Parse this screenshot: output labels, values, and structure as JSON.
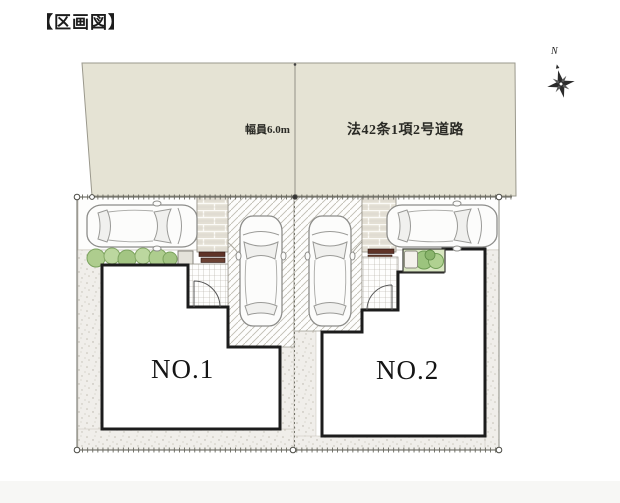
{
  "title": "【区画図】",
  "road": {
    "width_label": "幅員6.0m",
    "type_label": "法42条1項2号道路"
  },
  "compass": {
    "label": "N"
  },
  "lots": [
    {
      "label": "NO.1"
    },
    {
      "label": "NO.2"
    }
  ],
  "colors": {
    "road_fill": "#e5e3d4",
    "building_outline": "#1c1c1c",
    "building_fill": "#ffffff",
    "gravel_fill": "#f0eeea",
    "bush_green": "#aecd8e",
    "planting_bed_green": "#d9e7c2",
    "mat_brown": "#5f3327",
    "brick_fill": "#e3dfd4",
    "boundary_line": "#5a5a52"
  }
}
